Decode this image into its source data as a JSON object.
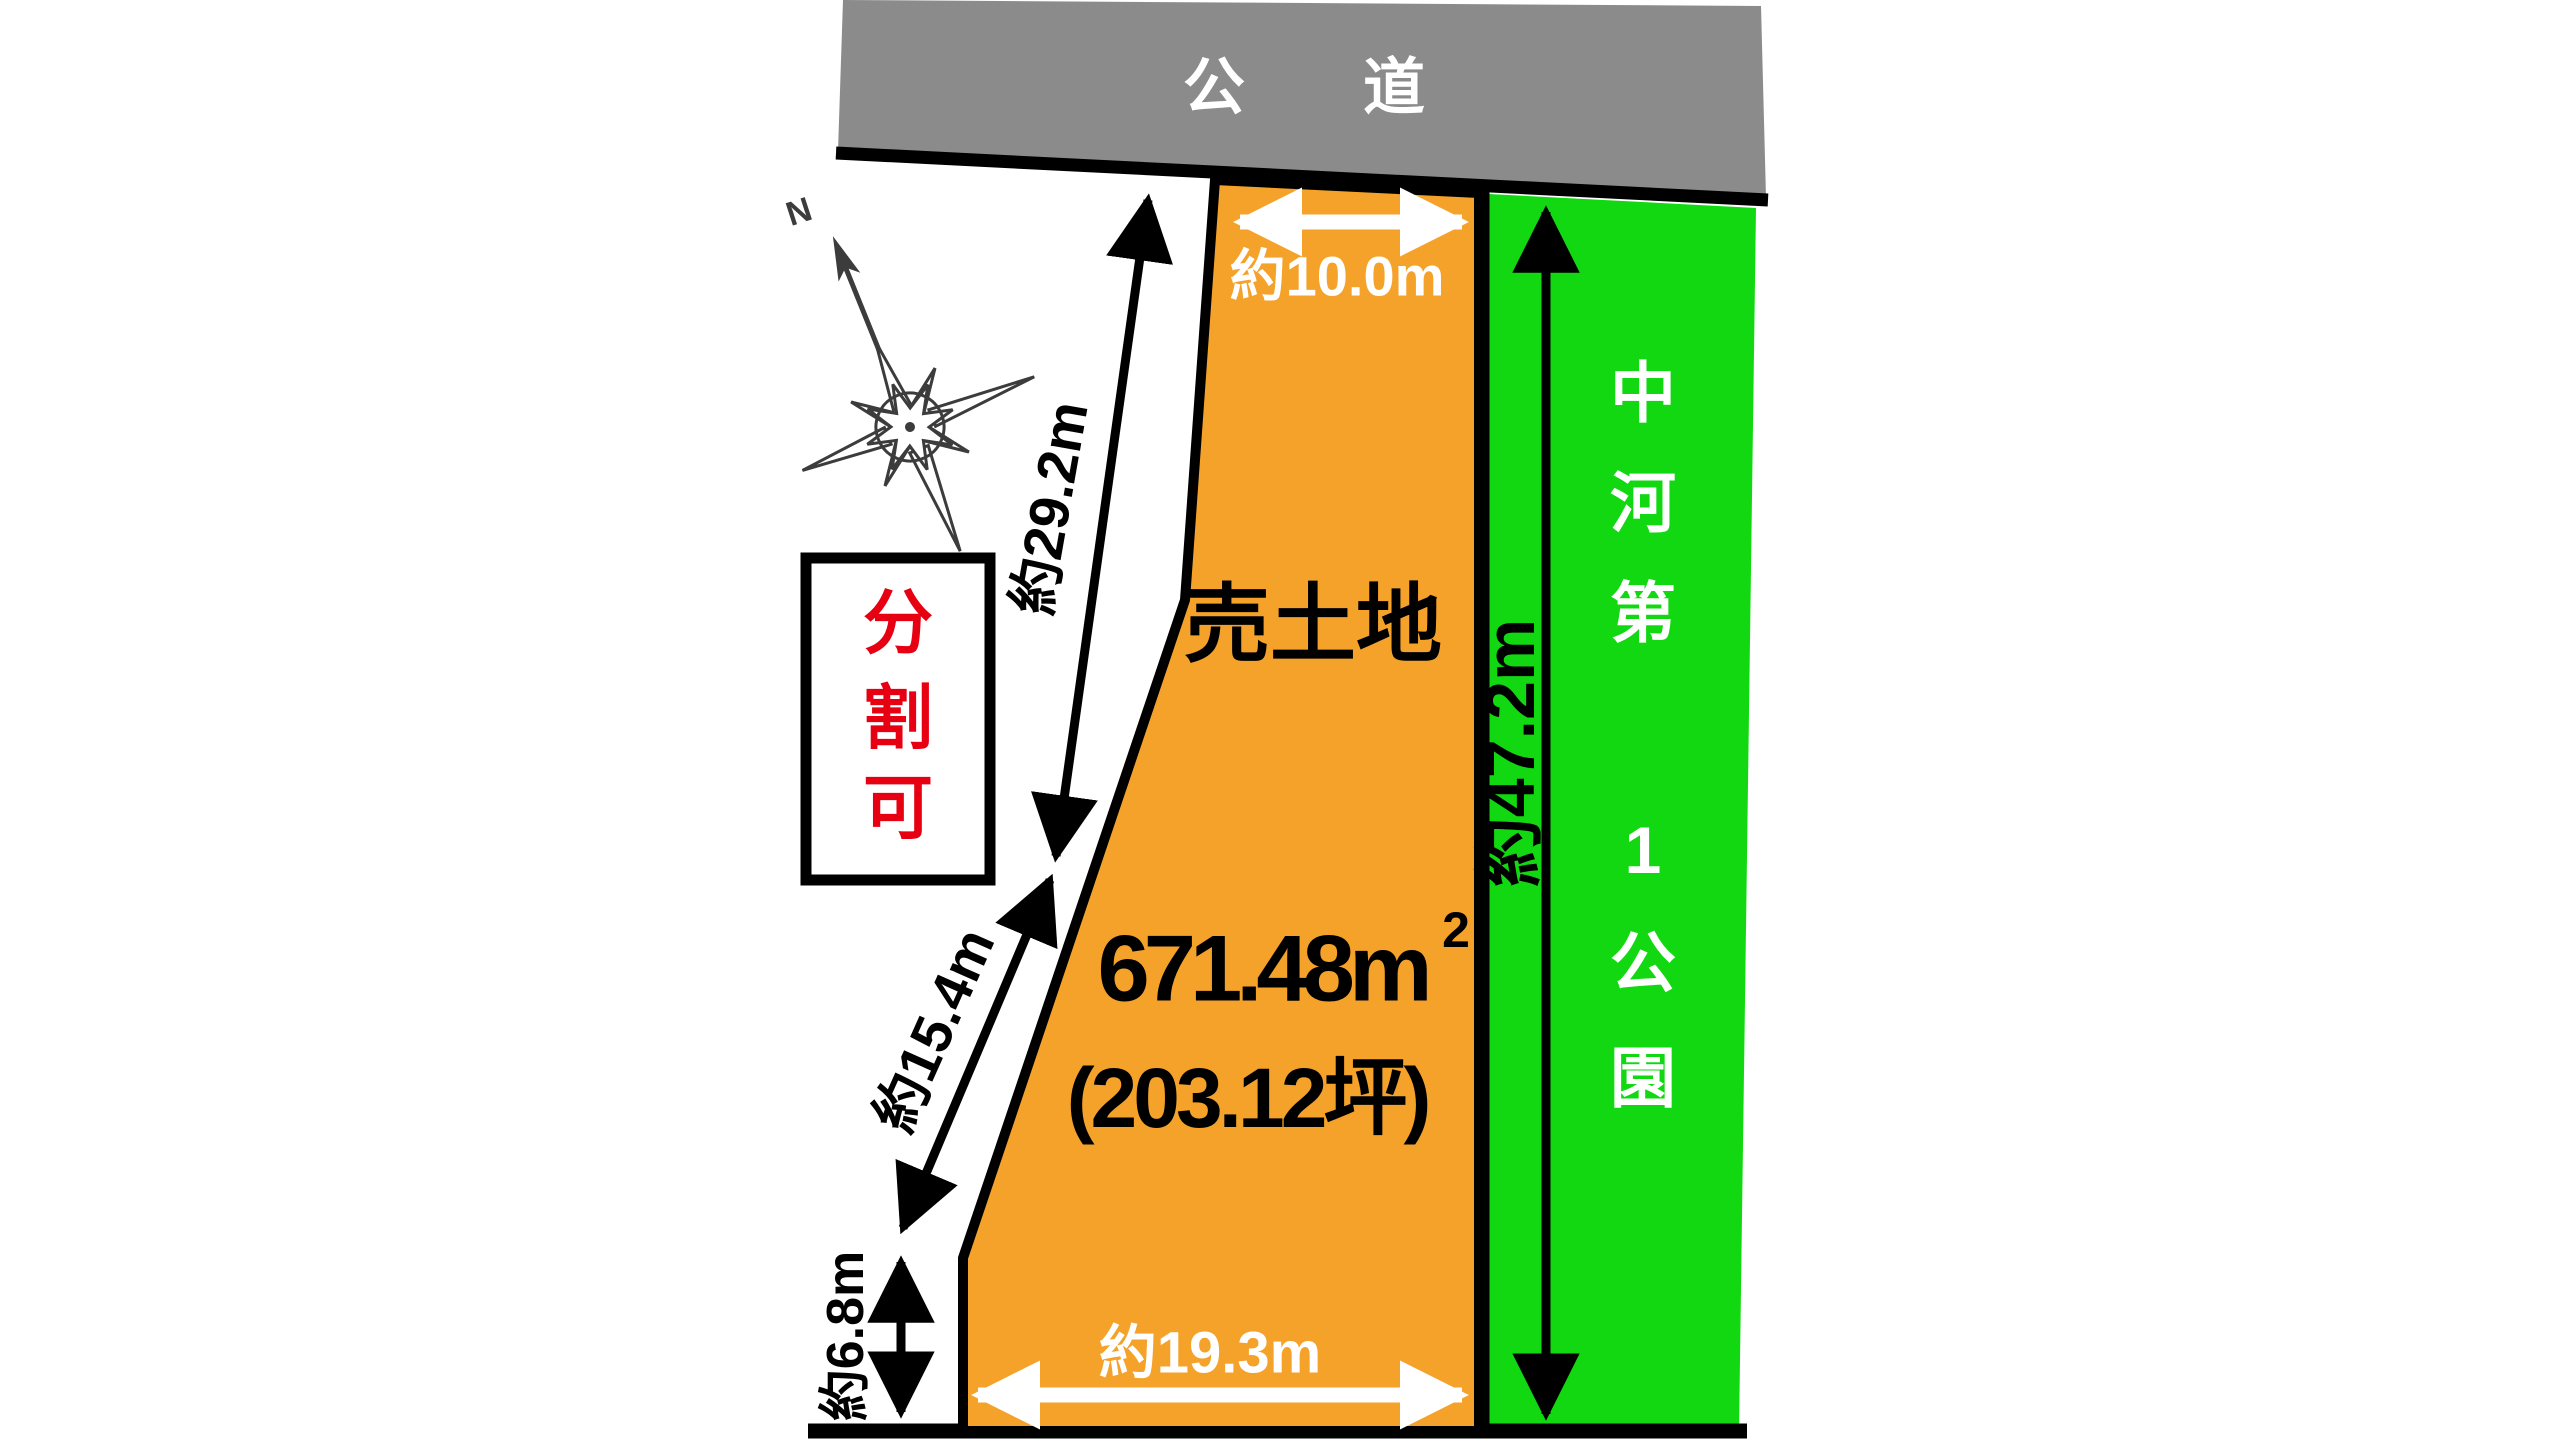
{
  "colors": {
    "background": "#ffffff",
    "road_fill": "#8b8b8b",
    "parcel_fill": "#f5a22b",
    "park_fill": "#12d812",
    "outline": "#000000",
    "badge_box_fill": "#ffffff",
    "badge_text_red": "#e60012",
    "white_text": "#ffffff",
    "compass_stroke": "#3c3c3c"
  },
  "road": {
    "label": "公　道"
  },
  "parcel": {
    "label": "売土地",
    "area_main": "671.48m",
    "area_sup": "2",
    "area_tsubo": "(203.12坪)"
  },
  "park": {
    "name": "中河第1公園",
    "name_chars": [
      "中",
      "河",
      "第",
      "1",
      "公",
      "園"
    ]
  },
  "badge": {
    "label": "分割可",
    "chars": [
      "分",
      "割",
      "可"
    ]
  },
  "compass": {
    "north_label": "N"
  },
  "dimensions": {
    "top_width": "約10.0m",
    "bottom_width": "約19.3m",
    "park_side": "約47.2m",
    "left_upper": "約29.2m",
    "left_middle": "約15.4m",
    "left_lower": "約6.8m"
  }
}
